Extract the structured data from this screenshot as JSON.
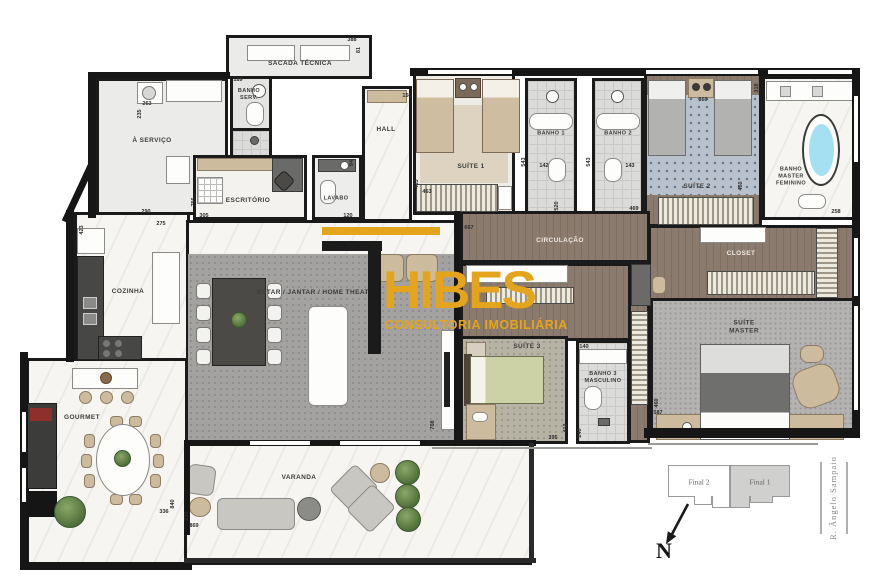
{
  "rooms": {
    "sacada": "SACADA TÉCNICA",
    "servico": "À SERVIÇO",
    "banho_serv": "BANHO\nSERV.",
    "escritorio": "ESCRITÓRIO",
    "lavabo": "LAVABO",
    "hall": "HALL",
    "suite1": "SUÍTE 1",
    "banho1": "BANHO 1",
    "banho2": "BANHO 2",
    "suite2": "SUÍTE 2",
    "banho_master": "BANHO\nMASTER\nFEMININO",
    "circulacao": "CIRCULAÇÃO",
    "closet": "CLOSET",
    "suite_master": "SUÍTE\nMASTER",
    "suite3": "SUÍTE 3",
    "banho3": "BANHO 3\nMASCULINO",
    "cozinha": "COZINHA",
    "estar": "ESTAR / JANTAR / HOME THEATER",
    "gourmet": "GOURMET",
    "varanda": "VARANDA"
  },
  "watermark": {
    "brand": "HIBES",
    "tagline": "CONSULTORIA IMOBILIÁRIA"
  },
  "keyplan": {
    "unit_left": "Final 2",
    "unit_right": "Final 1",
    "street": "R. Ângelo Sampaio",
    "north": "N"
  },
  "colors": {
    "accent_gold": "#E4A41C",
    "wall": "#161616",
    "bathtub_blue": "#a5dff2"
  },
  "dimensions": [
    {
      "t": "388",
      "x": 352,
      "y": 40,
      "r": 0
    },
    {
      "t": "81",
      "x": 359,
      "y": 50,
      "r": 1
    },
    {
      "t": "189",
      "x": 238,
      "y": 80,
      "r": 0
    },
    {
      "t": "263",
      "x": 147,
      "y": 104,
      "r": 0
    },
    {
      "t": "235",
      "x": 140,
      "y": 114,
      "r": 1
    },
    {
      "t": "290",
      "x": 146,
      "y": 212,
      "r": 0
    },
    {
      "t": "275",
      "x": 161,
      "y": 224,
      "r": 0
    },
    {
      "t": "305",
      "x": 204,
      "y": 216,
      "r": 0
    },
    {
      "t": "120",
      "x": 348,
      "y": 216,
      "r": 0
    },
    {
      "t": "756",
      "x": 194,
      "y": 202,
      "r": 1
    },
    {
      "t": "150",
      "x": 407,
      "y": 96,
      "r": 0
    },
    {
      "t": "94",
      "x": 352,
      "y": 163,
      "r": 1
    },
    {
      "t": "433",
      "x": 417,
      "y": 184,
      "r": 1
    },
    {
      "t": "463",
      "x": 427,
      "y": 192,
      "r": 0
    },
    {
      "t": "520",
      "x": 557,
      "y": 206,
      "r": 1
    },
    {
      "t": "667",
      "x": 469,
      "y": 228,
      "r": 0
    },
    {
      "t": "469",
      "x": 634,
      "y": 209,
      "r": 0
    },
    {
      "t": "543",
      "x": 524,
      "y": 162,
      "r": 1
    },
    {
      "t": "543",
      "x": 589,
      "y": 162,
      "r": 1
    },
    {
      "t": "142",
      "x": 544,
      "y": 166,
      "r": 0
    },
    {
      "t": "143",
      "x": 630,
      "y": 166,
      "r": 0
    },
    {
      "t": "360",
      "x": 703,
      "y": 100,
      "r": 0
    },
    {
      "t": "460",
      "x": 741,
      "y": 186,
      "r": 1
    },
    {
      "t": "318",
      "x": 757,
      "y": 88,
      "r": 1
    },
    {
      "t": "258",
      "x": 836,
      "y": 212,
      "r": 0
    },
    {
      "t": "395",
      "x": 553,
      "y": 438,
      "r": 0
    },
    {
      "t": "413",
      "x": 566,
      "y": 428,
      "r": 1
    },
    {
      "t": "140",
      "x": 584,
      "y": 347,
      "r": 0
    },
    {
      "t": "240",
      "x": 580,
      "y": 433,
      "r": 1
    },
    {
      "t": "708",
      "x": 433,
      "y": 425,
      "r": 1
    },
    {
      "t": "587",
      "x": 658,
      "y": 413,
      "r": 0
    },
    {
      "t": "460",
      "x": 657,
      "y": 403,
      "r": 1
    },
    {
      "t": "336",
      "x": 164,
      "y": 512,
      "r": 0
    },
    {
      "t": "840",
      "x": 173,
      "y": 504,
      "r": 1
    },
    {
      "t": "210",
      "x": 187,
      "y": 516,
      "r": 1
    },
    {
      "t": "869",
      "x": 194,
      "y": 526,
      "r": 0
    },
    {
      "t": "423",
      "x": 82,
      "y": 230,
      "r": 1
    }
  ]
}
